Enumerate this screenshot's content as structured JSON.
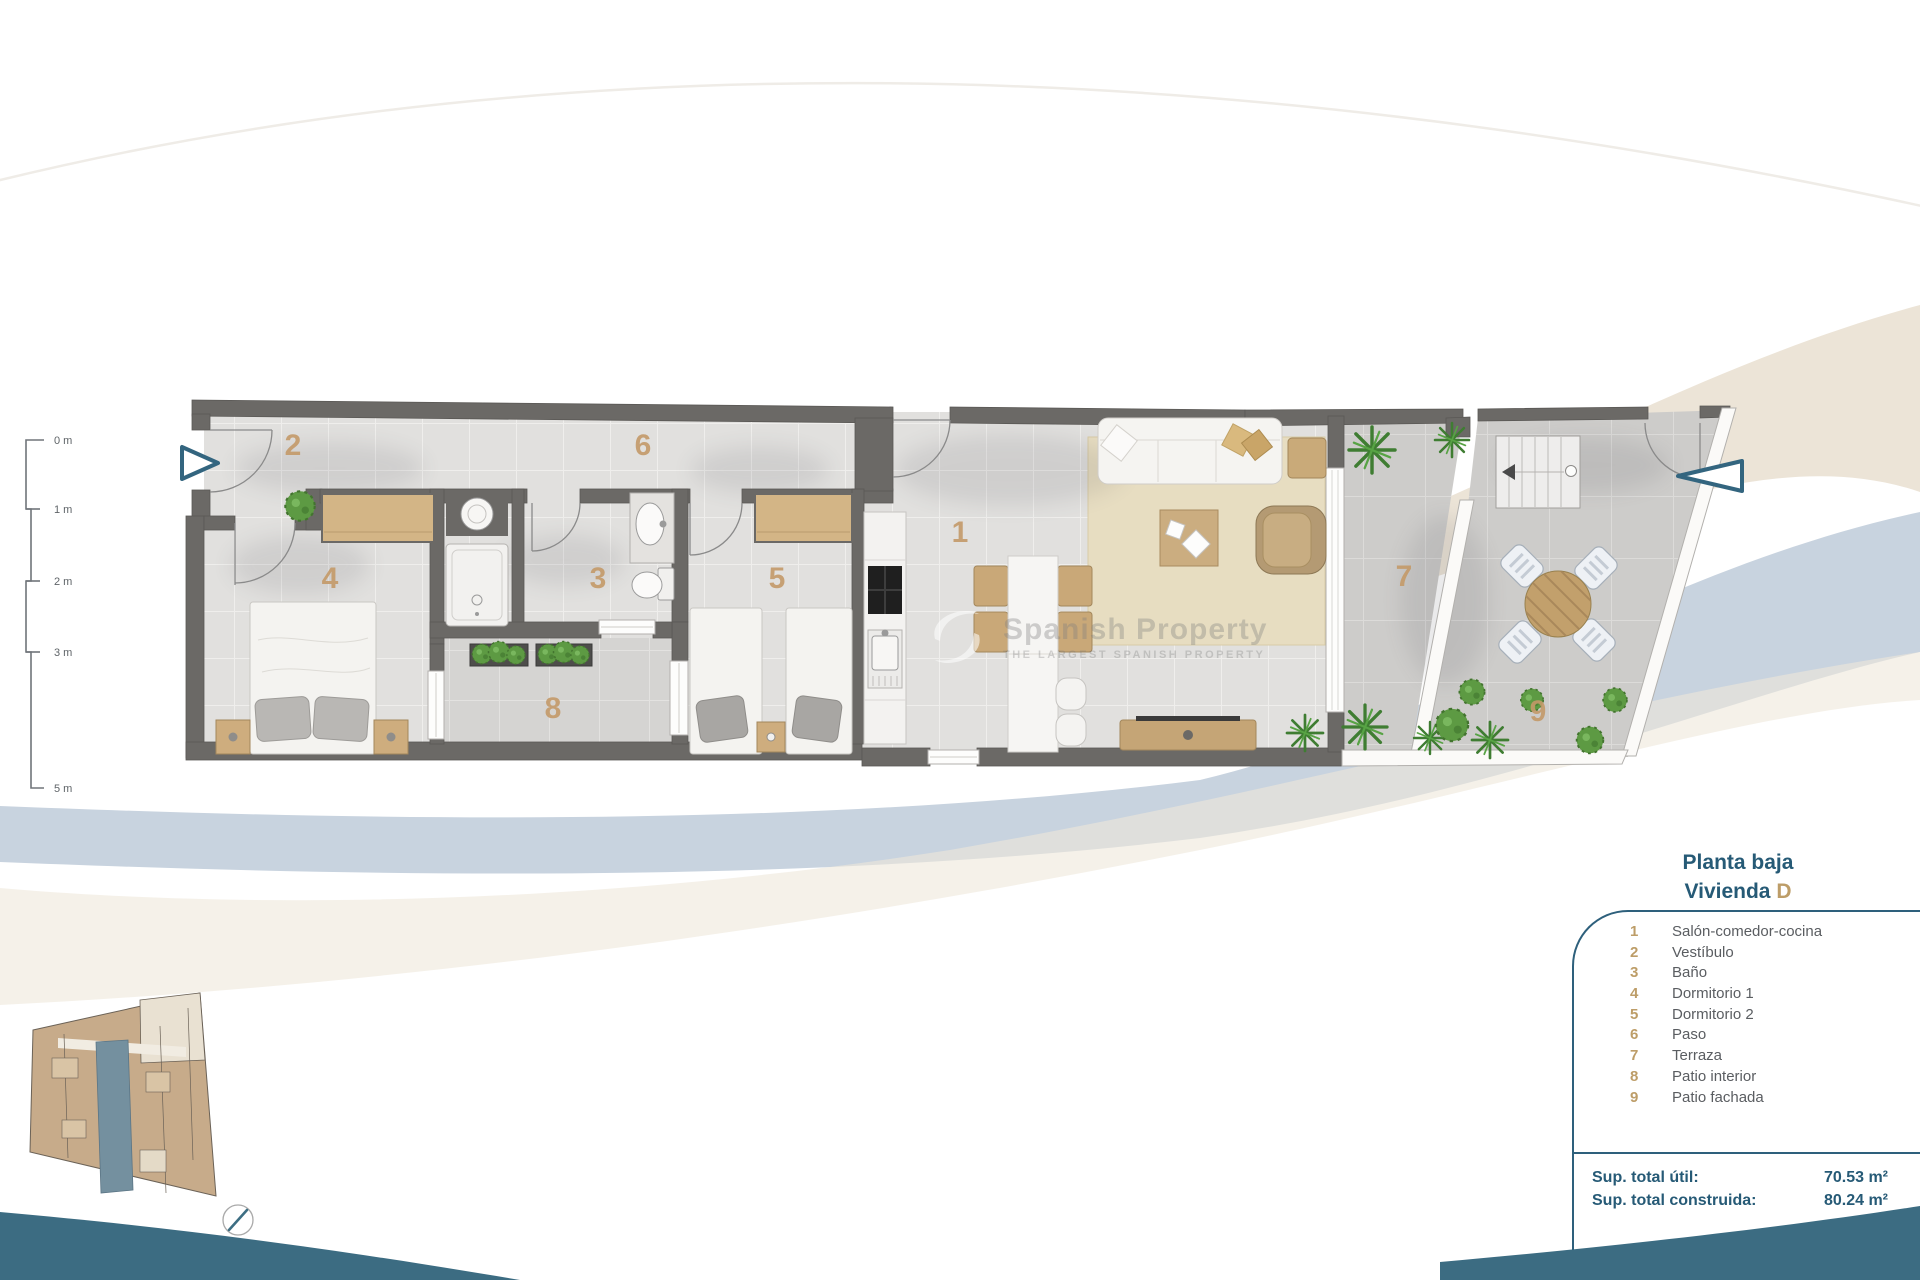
{
  "panel": {
    "title_line1": "Planta baja",
    "title_line2_label": "Vivienda",
    "title_line2_unit": "D",
    "legend": [
      {
        "num": "1",
        "label": "Salón-comedor-cocina"
      },
      {
        "num": "2",
        "label": "Vestíbulo"
      },
      {
        "num": "3",
        "label": "Baño"
      },
      {
        "num": "4",
        "label": "Dormitorio 1"
      },
      {
        "num": "5",
        "label": "Dormitorio 2"
      },
      {
        "num": "6",
        "label": "Paso"
      },
      {
        "num": "7",
        "label": "Terraza"
      },
      {
        "num": "8",
        "label": "Patio interior"
      },
      {
        "num": "9",
        "label": "Patio fachada"
      }
    ],
    "totals": {
      "useful_label": "Sup. total útil:",
      "useful_value": "70.53 m²",
      "built_label": "Sup. total construida:",
      "built_value": "80.24 m²"
    }
  },
  "scalebar": {
    "ticks": [
      "0 m",
      "1 m",
      "2 m",
      "3 m",
      "5 m"
    ]
  },
  "plan": {
    "room_numbers": [
      "1",
      "2",
      "3",
      "4",
      "5",
      "6",
      "7",
      "8",
      "9"
    ]
  },
  "watermark": {
    "line1": "Spanish Property",
    "line2": "THE LARGEST SPANISH PROPERTY"
  },
  "colors": {
    "accent_teal": "#2e607c",
    "number_tan": "#bd9d68",
    "wave_teal": "#3c6c82",
    "wall_gray": "#6b6966",
    "highlight_unit_blue": "#74909f",
    "band_beige": "#ece4d7",
    "band_blue": "#c8d3df"
  }
}
